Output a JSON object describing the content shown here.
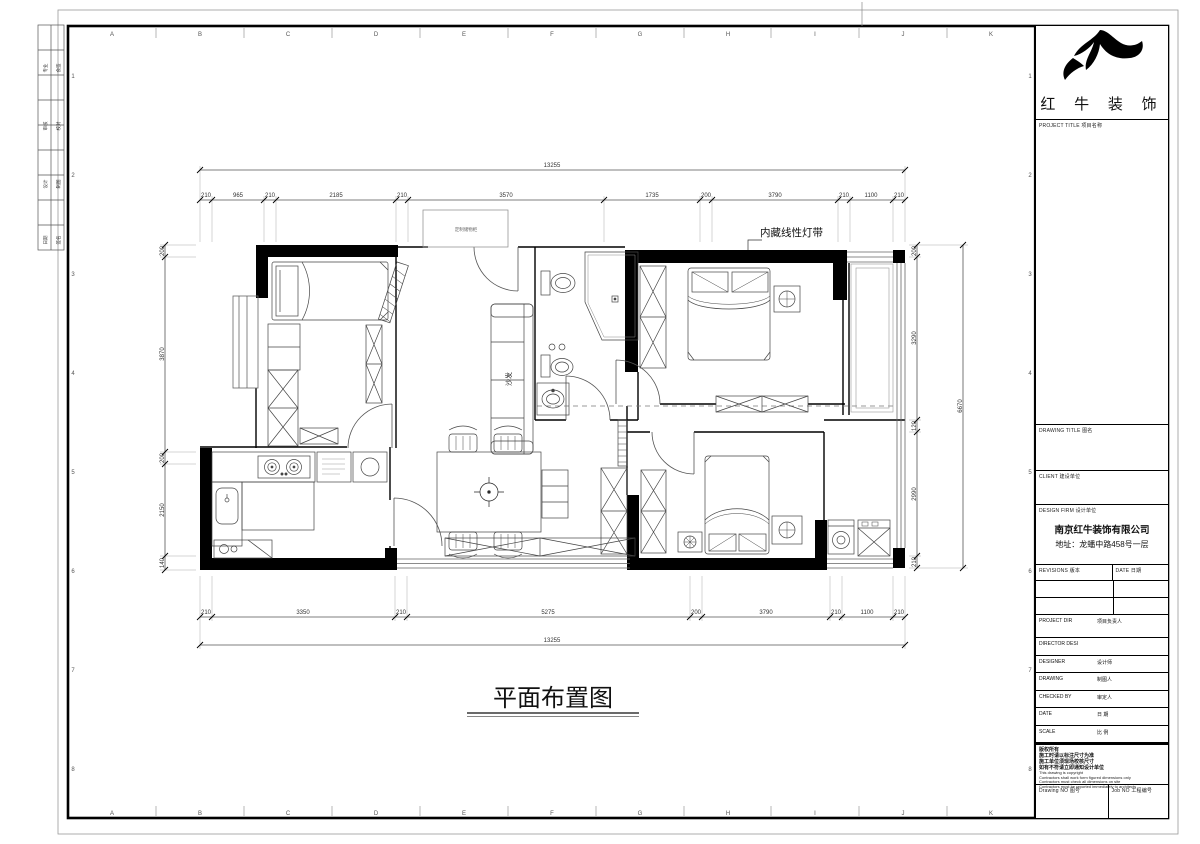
{
  "sheet": {
    "grid_letters": [
      "A",
      "B",
      "C",
      "D",
      "E",
      "F",
      "G",
      "H",
      "I",
      "J",
      "K"
    ],
    "grid_numbers": [
      "1",
      "2",
      "3",
      "4",
      "5",
      "6",
      "7",
      "8"
    ],
    "stamp_rows": [
      {
        "a": "专业",
        "b": "会签"
      },
      {
        "a": "审核",
        "b": "校对"
      },
      {
        "a": "设计",
        "b": "制图"
      },
      {
        "a": "日期",
        "b": "签名"
      }
    ]
  },
  "title_block": {
    "logo_text": "红 牛 装 饰",
    "project_title_label": "PROJECT TITLE  项目名称",
    "drawing_title_label": "DRAWING TITLE  图名",
    "client_label": "CLIENT  建设单位",
    "design_firm_label": "DESIGN FIRM  设计单位",
    "firm_name": "南京红牛装饰有限公司",
    "firm_address": "地址：龙蟠中路458号一层",
    "revisions_label": "REVISIONS  版本",
    "revisions_date_label": "DATE  日期",
    "rows": [
      {
        "en": "PROJECT DIR",
        "cn": "项目负责人"
      },
      {
        "en": "DIRECTOR DESI",
        "cn": ""
      },
      {
        "en": "DESIGNER",
        "cn": "设计师"
      },
      {
        "en": "DRAWING",
        "cn": "制图人"
      },
      {
        "en": "CHECKED BY",
        "cn": "审定人"
      },
      {
        "en": "DATE",
        "cn": "日  期"
      },
      {
        "en": "SCALE",
        "cn": "比  例"
      }
    ],
    "copyright_lines": [
      "版权所有",
      "施工时请以标注尺寸为准",
      "施工单位须现场校核尺寸",
      "如有不符请立即通知设计单位",
      "This drawing is copyright",
      "Contractors shall work form figured dimensions only",
      "Contractors must check all dimensions on site",
      "Contractors must be reported immediately to architects"
    ],
    "drawing_no_label": "Drawing NO  图号",
    "job_no_label": "Job NO  工程编号"
  },
  "plan": {
    "title": "平面布置图",
    "labels": {
      "sofa": "沙发",
      "light_strip": "内藏线性灯带",
      "entry_cabinet": "定制储物柜"
    },
    "dims": {
      "top_overall": "13255",
      "bottom_overall": "13255",
      "right_overall": "6670",
      "top": [
        "210",
        "965",
        "210",
        "2185",
        "210",
        "3570",
        "1735",
        "200",
        "3790",
        "210",
        "1100",
        "210"
      ],
      "bottom": [
        "210",
        "3350",
        "210",
        "5275",
        "200",
        "3790",
        "210",
        "1100",
        "210"
      ],
      "left": [
        "200",
        "3870",
        "200",
        "2150",
        "140"
      ],
      "right": [
        "200",
        "3290",
        "120",
        "2990",
        "210"
      ]
    }
  }
}
